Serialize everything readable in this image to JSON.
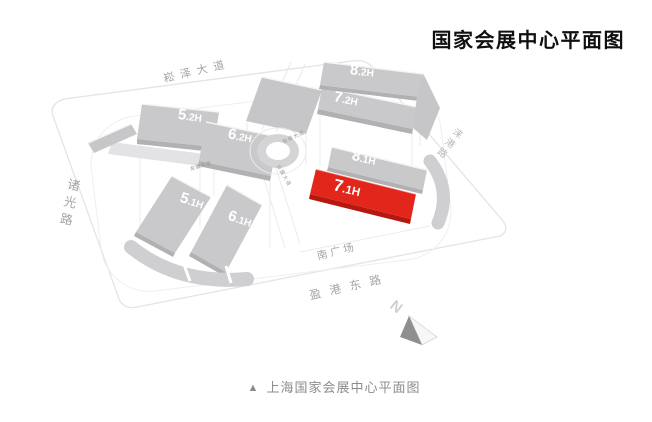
{
  "page": {
    "title": "国家会展中心平面图",
    "caption": {
      "marker": "▲",
      "text": "上海国家会展中心平面图"
    }
  },
  "map": {
    "halls": [
      {
        "id": "5.2H",
        "big": "5",
        "small": ".2H"
      },
      {
        "id": "6.2H",
        "big": "6",
        "small": ".2H"
      },
      {
        "id": "7.2H",
        "big": "7",
        "small": ".2H"
      },
      {
        "id": "8.2H",
        "big": "8",
        "small": ".2H"
      },
      {
        "id": "8.1H",
        "big": "8",
        "small": ".1H"
      },
      {
        "id": "7.1H",
        "big": "7",
        "small": ".1H",
        "highlighted": true
      },
      {
        "id": "5.1H",
        "big": "5",
        "small": ".1H"
      },
      {
        "id": "6.1H",
        "big": "6",
        "small": ".1H"
      }
    ],
    "roads": [
      {
        "name": "崧泽大道"
      },
      {
        "name": "诸光路"
      },
      {
        "name": "涞港路"
      },
      {
        "name": "南广场"
      },
      {
        "name": "盈港东路"
      },
      {
        "name": "会展大道"
      },
      {
        "name": "会展大道"
      },
      {
        "name": "会展大道"
      }
    ],
    "compass": {
      "label": "N"
    },
    "colors": {
      "highlight_hall": "#e2261c",
      "highlight_hall_side": "#b6170e",
      "hall_gray": "#c9c9cb",
      "hall_gray_side": "#b1b1b3",
      "platform_gray": "#e3e3e5",
      "boundary_outline": "#e4e4e4",
      "road_label": "#a5a5a5",
      "title_color": "#101010",
      "caption_color": "#8c8c8c"
    }
  }
}
